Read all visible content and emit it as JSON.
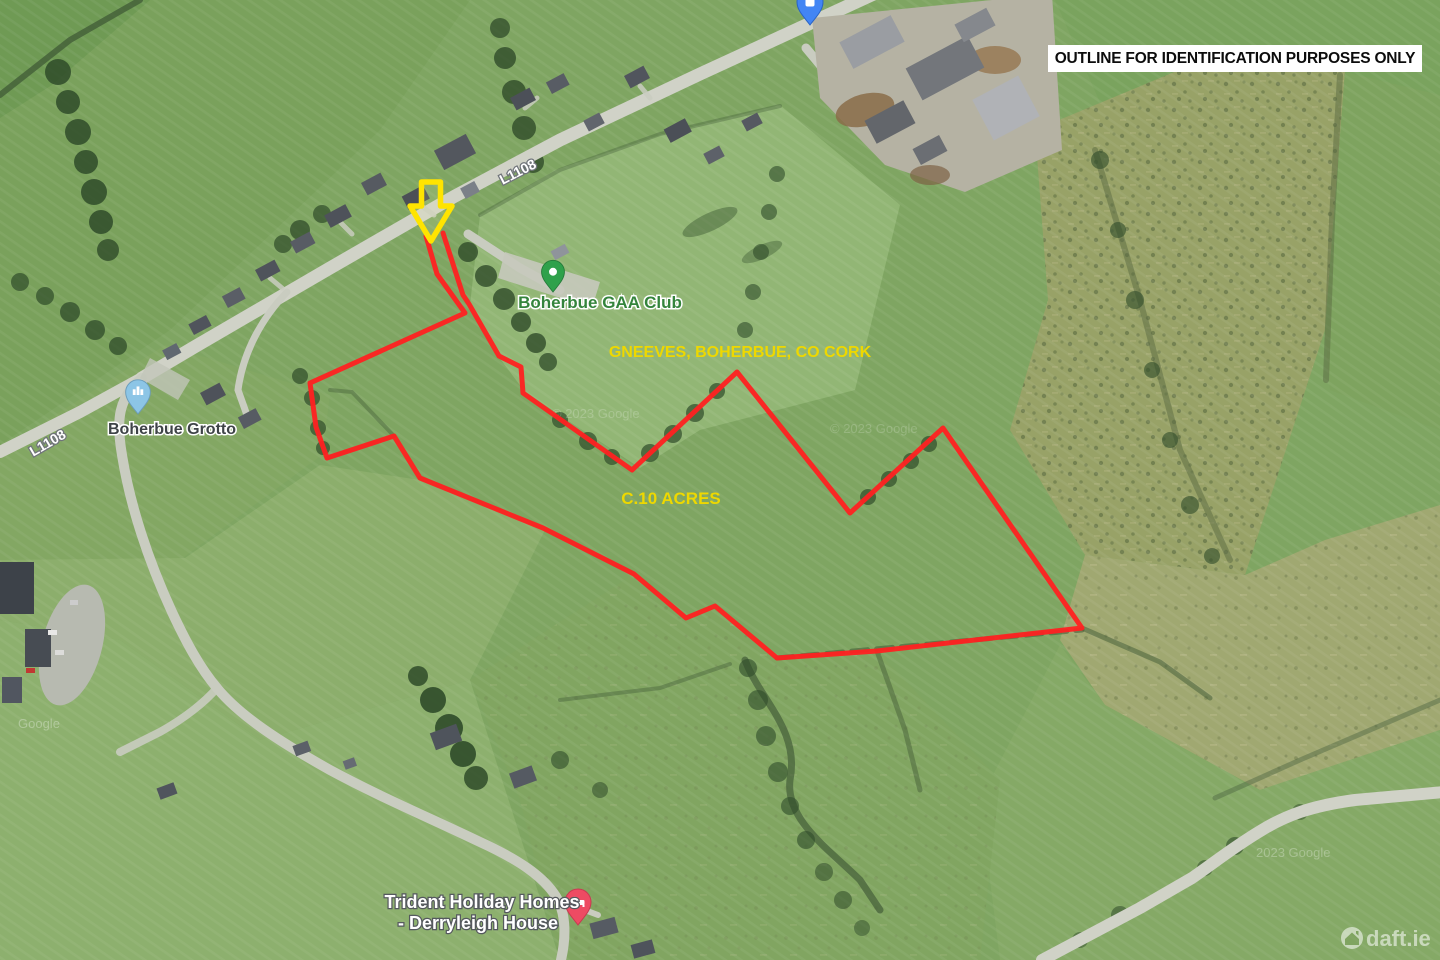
{
  "annotations": {
    "notice": "OUTLINE FOR IDENTIFICATION PURPOSES ONLY",
    "location": "GNEEVES, BOHERBUE, CO CORK",
    "area": "C.10 ACRES",
    "outline_color": "#ff2121",
    "arrow_color": "#ffe400",
    "label_color": "#eed800"
  },
  "map": {
    "road_labels": [
      {
        "text": "L1108"
      },
      {
        "text": "L1108"
      }
    ],
    "pois": [
      {
        "label": "Boherbue GAA Club",
        "pin_color": "#2fa14b"
      },
      {
        "label": "Boherbue Grotto",
        "pin_color": "#8cc5e6"
      },
      {
        "line1": "Trident Holiday Homes",
        "line2": "- Derryleigh House",
        "pin_color": "#ee4b63"
      },
      {
        "label": "",
        "pin_color": "#4285f4"
      }
    ],
    "attributions": [
      "© 2023 Google",
      "© 2023 Google",
      "2023 Google",
      "Google"
    ],
    "brand": "daft.ie"
  }
}
